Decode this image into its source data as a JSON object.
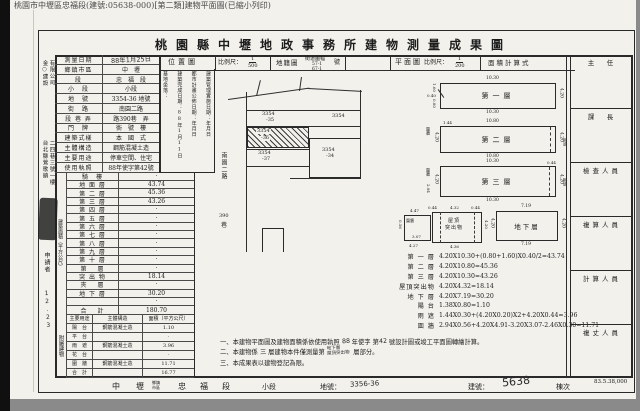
{
  "page": {
    "print_header": "桃園市中壢區忠福段(建號:05638-000)[第二類]建物平面圖(已縮小列印)",
    "title": "桃園縣中壢地政事務所建物測量成果圖",
    "film_code": "83.5.38,000"
  },
  "band": {
    "location": "位置圖",
    "scale_label": "比例尺：",
    "scale1_num": "1",
    "scale1_den": "500",
    "cadastre": "地籍圖",
    "sheet_label": "街道圖幅",
    "sheet_no": "號",
    "sheet_v1": "57-1",
    "sheet_v2": "67-1",
    "plan": "平面圖",
    "scale2_num": "1",
    "scale2_den": "200",
    "calc": "面積計算式"
  },
  "survey": {
    "date_label": "測量日期",
    "date_value": "88年1月25日"
  },
  "info_rows": [
    {
      "label": "鄉鎮市區",
      "value": "中　壢"
    },
    {
      "label": "段",
      "value": "忠　福　段"
    },
    {
      "label": "小　段",
      "value": "小段"
    },
    {
      "label": "地　號",
      "value": "3354-36 地號"
    },
    {
      "label": "街　路",
      "value": "南園二路"
    },
    {
      "label": "段 巷 弄",
      "value": "路390巷　弄"
    },
    {
      "label": "門　牌",
      "value": "衖　號　樓"
    },
    {
      "label": "建築式樣",
      "value": "本　國　式"
    },
    {
      "label": "主體構造",
      "value": "鋼筋混凝土造"
    },
    {
      "label": "主要用途",
      "value": "停車空間、住宅"
    },
    {
      "label": "使用執照",
      "value": "88年使字第42號"
    }
  ],
  "dates_cell": {
    "c1": "基地坐落：",
    "c2": "建築完成日期：88年1月11日",
    "c3": "都市計畫公佈日期：年月日",
    "c4": "建築管理實施日期：年月日"
  },
  "side_labels": {
    "area": "建築面積（平方公尺）",
    "attached": "附屬建物"
  },
  "area_rows": [
    {
      "label": "騎　樓",
      "value": "·"
    },
    {
      "label": "地 面 層",
      "value": "43.74"
    },
    {
      "label": "第 二 層",
      "value": "45.36"
    },
    {
      "label": "第 三 層",
      "value": "43.26"
    },
    {
      "label": "第 四 層",
      "value": "·"
    },
    {
      "label": "第 五 層",
      "value": "·"
    },
    {
      "label": "第 六 層",
      "value": "·"
    },
    {
      "label": "第 七 層",
      "value": "·"
    },
    {
      "label": "第 八 層",
      "value": "·"
    },
    {
      "label": "第 九 層",
      "value": "·"
    },
    {
      "label": "第 十 層",
      "value": "·"
    },
    {
      "label": "第　 層",
      "value": "·"
    },
    {
      "label": "突 出 物",
      "value": "18.14"
    },
    {
      "label": "夾　 層",
      "value": "·"
    },
    {
      "label": "地 下 層",
      "value": "30.20"
    },
    {
      "label": "",
      "value": "·"
    },
    {
      "label": "合　 計",
      "value": "180.70"
    }
  ],
  "attached": {
    "headers": [
      "主要用途",
      "主體構造",
      "面積（平方公尺）"
    ],
    "rows": [
      {
        "u": "陽　台",
        "s": "鋼筋混凝土造",
        "a": "1.10"
      },
      {
        "u": "平　台",
        "s": "",
        "a": "·"
      },
      {
        "u": "雨　遮",
        "s": "鋼筋混凝土造",
        "a": "3.96"
      },
      {
        "u": "花　台",
        "s": "",
        "a": "·"
      },
      {
        "u": "圍　牆",
        "s": "鋼筋混凝土造",
        "a": "11.71"
      },
      {
        "u": "合　計",
        "s": "",
        "a": "16.77"
      }
    ]
  },
  "margin": {
    "name1": "金○建設",
    "name2": "有限公司",
    "addr1": "台北縣鶯歌鎮",
    "addr2": "二四巷三號一樓",
    "applicant": "申請者",
    "scribble": "12.23"
  },
  "map": {
    "street": "南園二路",
    "street_no": "390",
    "street_lane": "巷",
    "p35a": "3354",
    "p35b": "-35",
    "p0": "3354",
    "p36a": "3354",
    "p36b": "-36",
    "p37a": "3354",
    "p37b": "-37",
    "p34a": "3354",
    "p34b": "-34"
  },
  "officials": [
    "主　任",
    "課　長",
    "檢查人員",
    "複算人員",
    "計算人員",
    "複丈人員"
  ],
  "plans": {
    "p1": {
      "name": "第一層",
      "top": "10.30",
      "bottom": "10.30",
      "side": "4.20",
      "n1": "1.60",
      "n2": "0.40",
      "n3": "0.80"
    },
    "p2": {
      "name": "第二層",
      "top": "10.80",
      "bottom": "10.80",
      "sideL": "4.20",
      "sideR": "4.20",
      "wl": "圍牆",
      "wr": "雨遮",
      "d": "1.44"
    },
    "p3": {
      "name": "第三層",
      "top": "10.30",
      "bottom": "10.30",
      "sideL": "4.20",
      "sideR": "4.20",
      "wl": "圍牆",
      "wr": "雨遮",
      "d": "0.44",
      "d2": "2.94"
    },
    "p4": {
      "name1": "屋頂",
      "name2": "突出物",
      "top": "4.32",
      "bottom": "4.36",
      "side": "4.20",
      "g1": "0.44",
      "g2": "0.44",
      "wall": "圍牆",
      "wt": "4.47",
      "wb": "4.27",
      "wi": "3.07",
      "ws": "0.56"
    },
    "p5": {
      "name": "地下層",
      "top": "7.19",
      "bottom": "7.19",
      "sideL": "4.20",
      "sideR": "4.20"
    }
  },
  "calc_lines": [
    {
      "l": "第 一 層",
      "f": "4.20X10.30+(0.80+1.60)X0.40/2=43.74"
    },
    {
      "l": "第 二 層",
      "f": "4.20X10.80=45.36"
    },
    {
      "l": "第 三 層",
      "f": "4.20X10.30=43.26"
    },
    {
      "l": "屋頂突出物",
      "f": "4.20X4.32=18.14"
    },
    {
      "l": "地 下 層",
      "f": "4.20X7.19=30.20"
    },
    {
      "l": "陽 台",
      "f": "1.38X0.80=1.10"
    },
    {
      "l": "雨 遮",
      "f": "1.44X0.30+(4.20X0.20)X2+4.20X0.44=3.96"
    },
    {
      "l": "圍 牆",
      "f": "2.94X0.56+4.20X4.91-3.20X3.07-2.46X0.30=11.71"
    }
  ],
  "notes": {
    "n1a": "一、本建物平面圖及建物面積係依使用執照 ",
    "n1b": "88",
    "n1c": " 年使字 第",
    "n1d": "42",
    "n1e": " 號設計圖或竣工平面圖轉繪計算。",
    "n2a": "二、本建物係 ",
    "n2h": "三",
    "n2b": " 層建物本件僅測量第",
    "n2h2a": "地下層",
    "n2h2b": "屋頂突出物",
    "n2c": " 層部分。",
    "n3": "三、本成果表以建物登記為限。"
  },
  "bottom": {
    "district": "中　壢",
    "district_tag1": "鄉鎮",
    "district_tag2": "市區",
    "section": "忠　福　段",
    "subsection": "小段",
    "lot_label": "地號：",
    "lot_value": "3356-36",
    "bldg_label": "建號：",
    "bldg_value": "5638",
    "unit": "棟次"
  }
}
